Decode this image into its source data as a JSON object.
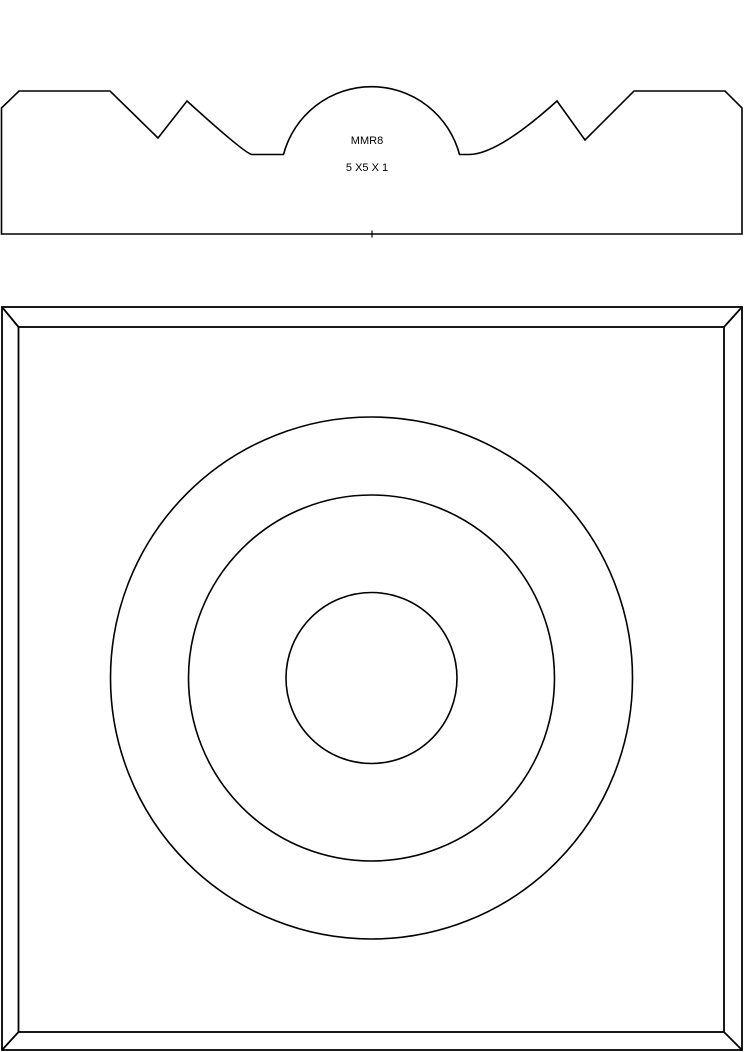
{
  "page": {
    "background_color": "#ffffff",
    "line_color": "#000000",
    "content": "technical line drawing of a millwork rosette: top profile cross-section and bottom plan view"
  },
  "profile_view": {
    "code": "MMR8",
    "size": "5 X5 X 1"
  },
  "plan_view": {
    "center": {
      "x": 371.5,
      "y": 678
    },
    "circle_radii": {
      "outer": 261,
      "middle": 183,
      "inner": 85.5
    }
  }
}
